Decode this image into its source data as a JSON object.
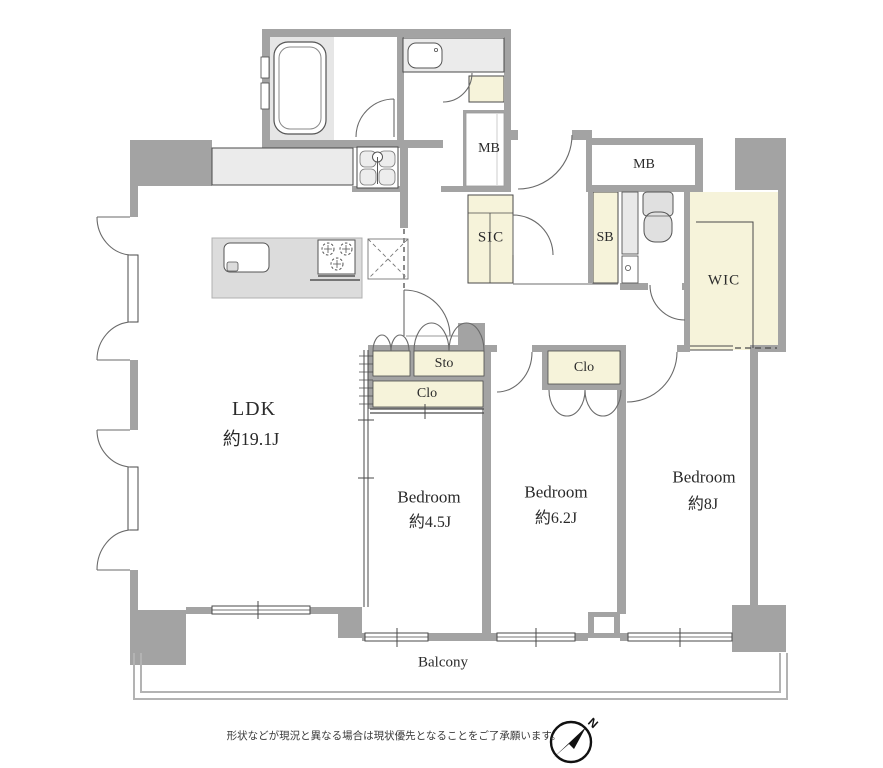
{
  "page": {
    "width": 883,
    "height": 768
  },
  "rooms": {
    "ldk": {
      "name": "LDK",
      "size": "約19.1J"
    },
    "bedroom_small": {
      "name": "Bedroom",
      "size": "約4.5J"
    },
    "bedroom_mid": {
      "name": "Bedroom",
      "size": "約6.2J"
    },
    "bedroom_large": {
      "name": "Bedroom",
      "size": "約8J"
    },
    "wic": {
      "name": "WIC"
    },
    "sic": {
      "name": "SIC"
    },
    "sb": {
      "name": "SB"
    },
    "mb_hall": {
      "name": "MB"
    },
    "mb_right": {
      "name": "MB"
    },
    "sto": {
      "name": "Sto"
    },
    "clo_bedroom_small": {
      "name": "Clo"
    },
    "clo_bedroom_mid": {
      "name": "Clo"
    },
    "balcony": {
      "name": "Balcony"
    }
  },
  "compass": {
    "north_label": "N"
  },
  "footer": {
    "disclaimer": "形状などが現況と異なる場合は現状優先となることをご了承願います。"
  },
  "colors": {
    "wall": "#a3a3a3",
    "closet_fill": "#f6f3da",
    "fixture_fill": "#e6e6e6",
    "line": "#4a4a4a"
  }
}
